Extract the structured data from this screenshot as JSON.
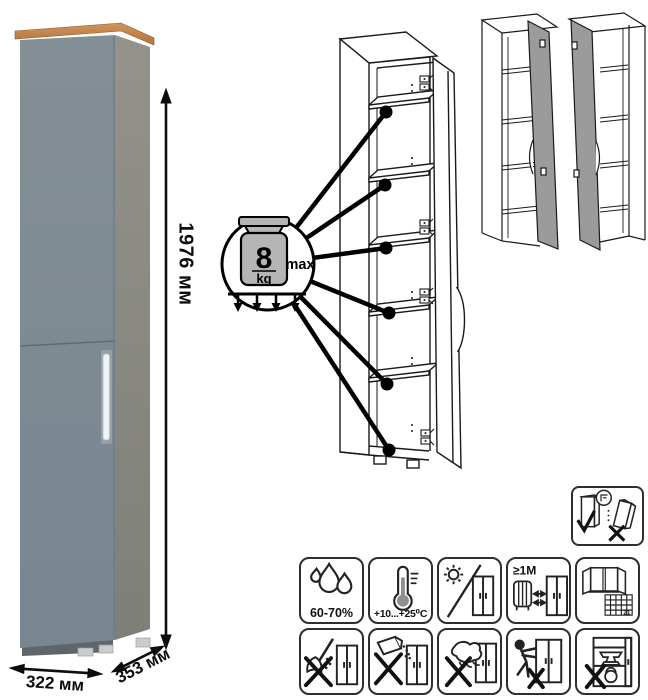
{
  "dimensions": {
    "height": "1976 мм",
    "width": "322 мм",
    "depth": "353 мм"
  },
  "shelf_load": {
    "value": "8",
    "unit": "kg",
    "qualifier": "max"
  },
  "icons": {
    "humidity_label": "60-70%",
    "temperature_label": "+10...+25⁰C",
    "distance_label": "≥1M",
    "calendar_day": "21"
  },
  "colors": {
    "wood_top": "#BE8045",
    "front_panel": "#7E8B91",
    "side_panel": "#8F9089",
    "handle": "#F0F3F3",
    "line_art": "#1a1a1a"
  }
}
